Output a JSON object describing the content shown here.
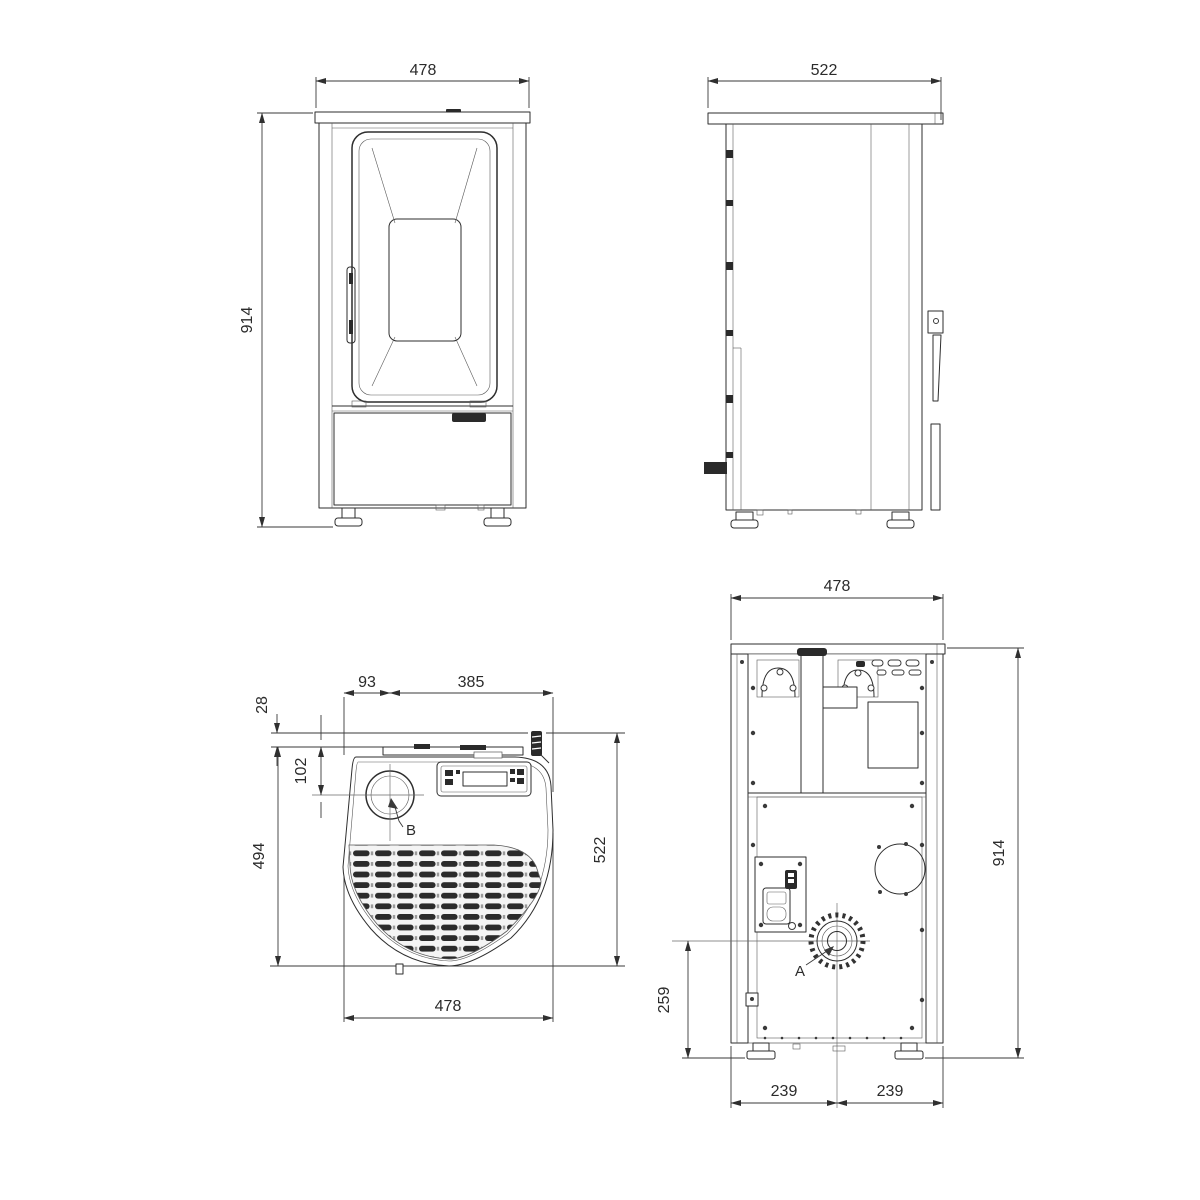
{
  "views": {
    "front": {
      "dim_width": "478",
      "dim_height": "914"
    },
    "side": {
      "dim_depth": "522"
    },
    "top": {
      "dim_flue_from_left": "93",
      "dim_flue_to_right": "385",
      "dim_lever_overhang": "28",
      "dim_flue_from_back": "102",
      "dim_body_depth": "494",
      "dim_total_depth": "522",
      "dim_width": "478",
      "label_flue": "B"
    },
    "back": {
      "dim_width": "478",
      "dim_height": "914",
      "dim_outlet_center_height": "259",
      "dim_center_to_left": "239",
      "dim_center_to_right": "239",
      "label_outlet": "A"
    }
  },
  "colors": {
    "background": "#ffffff",
    "line": "#2e2e2e",
    "dimension": "#3a3a3a"
  }
}
